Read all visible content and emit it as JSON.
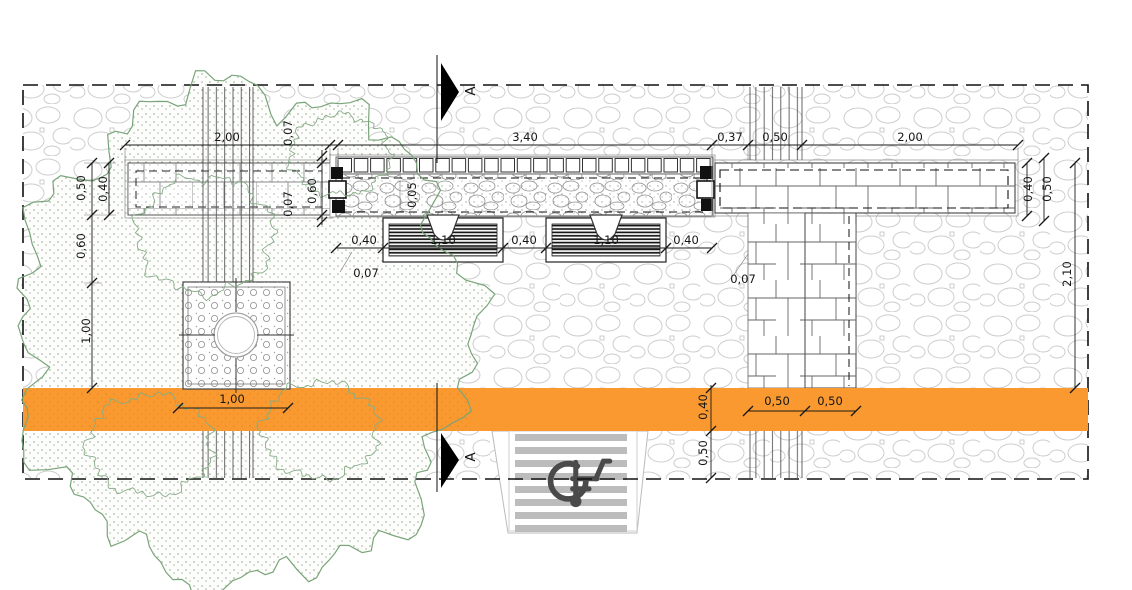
{
  "drawing": {
    "kind_note": "site plan with benches, planting bed, walls, tree pit, tactile ramp"
  },
  "dimensions": {
    "top_left_length": "2,00",
    "top_edge": "0,07",
    "top_bed_length": "3,40",
    "top_gap": "0,37",
    "top_strip": "0,50",
    "top_right_length": "2,00",
    "left_outer": "0,50",
    "left_wall": "0,40",
    "left_gap": "0,60",
    "left_planter": "1,00",
    "wall_depth": "0,60",
    "wall_edge": "0,07",
    "bed_edge": "0,05",
    "seat_gap_left": "0,40",
    "bench_left": "1,10",
    "seat_gap_mid": "0,40",
    "bench_right": "1,10",
    "seat_gap_right": "0,40",
    "bed_edge_left": "0,07",
    "bed_edge_right": "0,07",
    "rwall_width": "0,40",
    "rwall_outer": "0,50",
    "rwall_length": "2,10",
    "planter_width": "1,00",
    "cross_left": "0,50",
    "cross_right": "0,50",
    "band_width": "0,40",
    "band_offset": "0,50"
  },
  "section_markers": {
    "top": "A",
    "bottom": "A"
  },
  "colors": {
    "band_orange": "#F9992F",
    "canopy_green": "#79A479",
    "paving_gray": "#CDCDCD",
    "stripe_gray": "#BCBCBC",
    "symbol_gray": "#4A4A4A"
  }
}
